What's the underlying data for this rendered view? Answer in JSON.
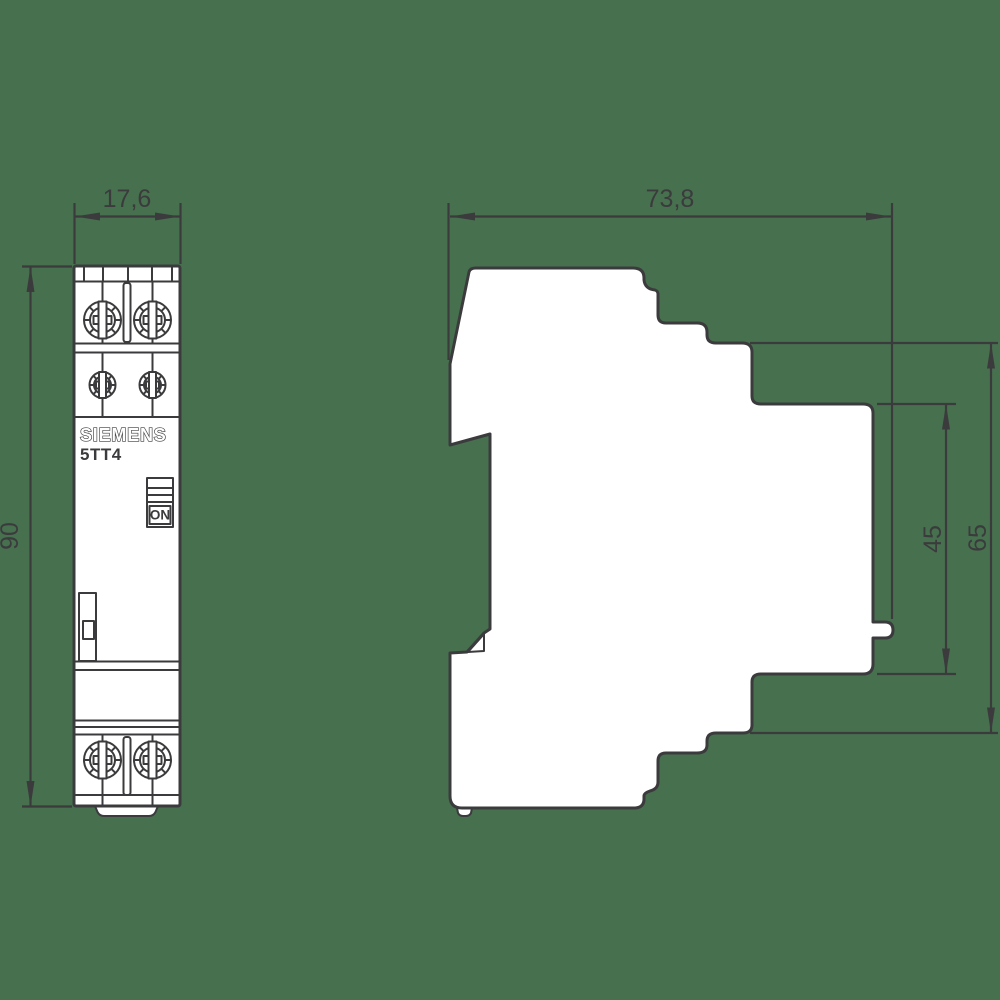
{
  "drawing": {
    "brand": "SIEMENS",
    "model": "5TT4",
    "switch_label": "ON",
    "dimensions": {
      "front_width": "17,6",
      "front_height": "90",
      "side_depth": "73,8",
      "front_face_height": "45",
      "body_height": "65"
    },
    "colors": {
      "background": "#47704E",
      "line": "#3B3B3D",
      "fill": "#FFFFFF"
    }
  }
}
